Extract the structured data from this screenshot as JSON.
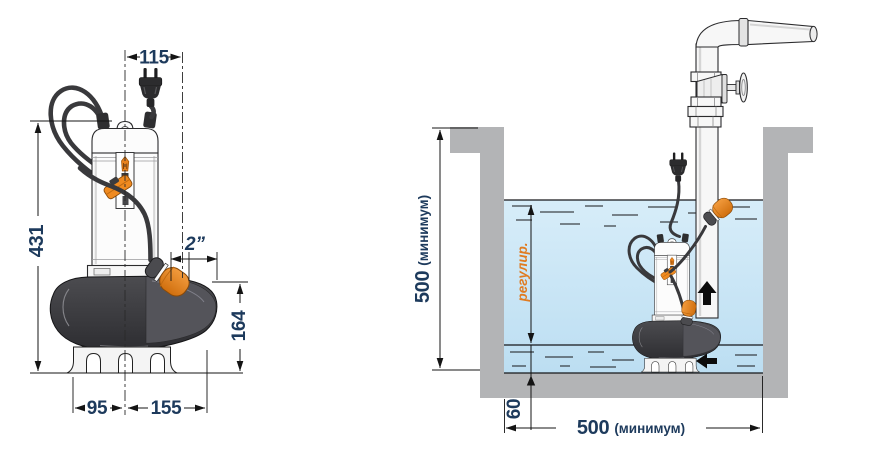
{
  "left_view": {
    "dim_plug_offset": "115",
    "dim_total_height": "431",
    "dim_discharge_port": "2”",
    "dim_casing_height": "164",
    "dim_base_left": "95",
    "dim_base_right": "155"
  },
  "right_view": {
    "dim_depth_value": "500",
    "dim_depth_unit": "(минимум)",
    "dim_width_value": "500",
    "dim_width_unit": "(минимум)",
    "dim_min_level": "60",
    "label_level_range": "регулир."
  },
  "icons": {
    "flow_up": "flow-up-arrow",
    "flow_in": "flow-inlet-arrow"
  },
  "colors": {
    "dimension_text": "#1d3a5c",
    "accent_orange": "#e8821e",
    "water": "#c9e5f5",
    "concrete": "#b3b4b6",
    "casing_dark": "#3a3a3d"
  }
}
